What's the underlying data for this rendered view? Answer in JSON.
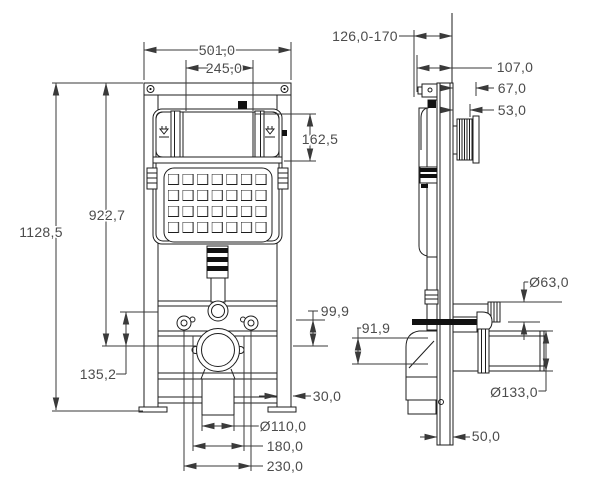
{
  "meta": {
    "title": "concealed-cistern-wall-frame-technical-drawing",
    "background": "#ffffff",
    "line_color": "#1e1e1e",
    "dimension_color": "#3a3a3a",
    "text_color": "#4c4c4c"
  },
  "front": {
    "d_width": "501,0",
    "d_opening_w": "245,0",
    "d_opening_h": "162,5",
    "d_height_outlet": "922,7",
    "d_height_total": "1128,5",
    "d_outlet_drop": "99,9",
    "d_outlet_bolt": "135,2",
    "d_leg_width": "30,0",
    "d_waste_dia": "Ø110,0",
    "d_pipe_span": "180,0",
    "d_bolt_span": "230,0"
  },
  "side": {
    "d_depth_range": "126,0-170",
    "d_depth": "107,0",
    "d_flush_conn": "67,0",
    "d_flush_rib": "53,0",
    "d_supply_dia": "Ø63,0",
    "d_elbow_drop": "91,9",
    "d_outlet_dia": "Ø133,0",
    "d_channel_w": "50,0"
  }
}
